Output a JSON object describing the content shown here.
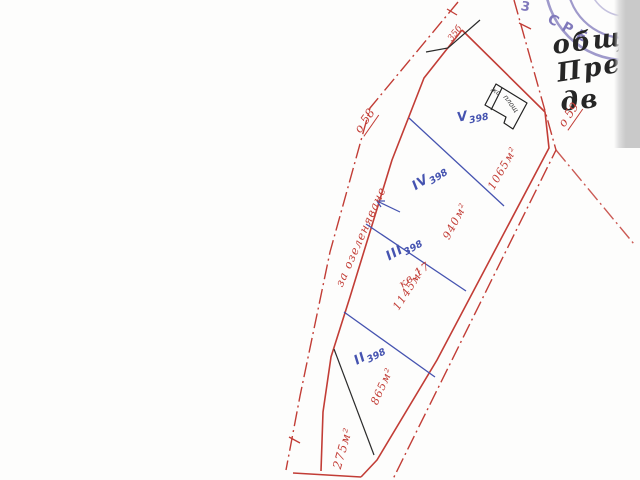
{
  "map": {
    "stamp": {
      "arc_text": "СРЕ",
      "fragment": "3"
    },
    "notes": {
      "line1": "общ",
      "line2": "Пре",
      "line3": "дв"
    },
    "axis_points": {
      "o58": "о 58",
      "o59": "о 59"
    },
    "edge_label": "за озеленяване",
    "apex_label": "35б",
    "block_label": "кв.17",
    "building": {
      "label1": "жс",
      "label2": "площ"
    },
    "parcels": [
      {
        "numeral": "V",
        "number": "398",
        "area": "1065м²"
      },
      {
        "numeral": "IV",
        "number": "398",
        "area": "940м²"
      },
      {
        "numeral": "III",
        "number": "398",
        "area": "1145м²"
      },
      {
        "numeral": "II",
        "number": "398",
        "area": "865м²"
      }
    ],
    "corner_area": "275м²"
  },
  "colors": {
    "boundary_red": "#c23d36",
    "parcel_blue": "#4553b0",
    "ink_black": "#262626",
    "stamp_purple": "#8079bb",
    "paper": "#fdfdfc"
  }
}
